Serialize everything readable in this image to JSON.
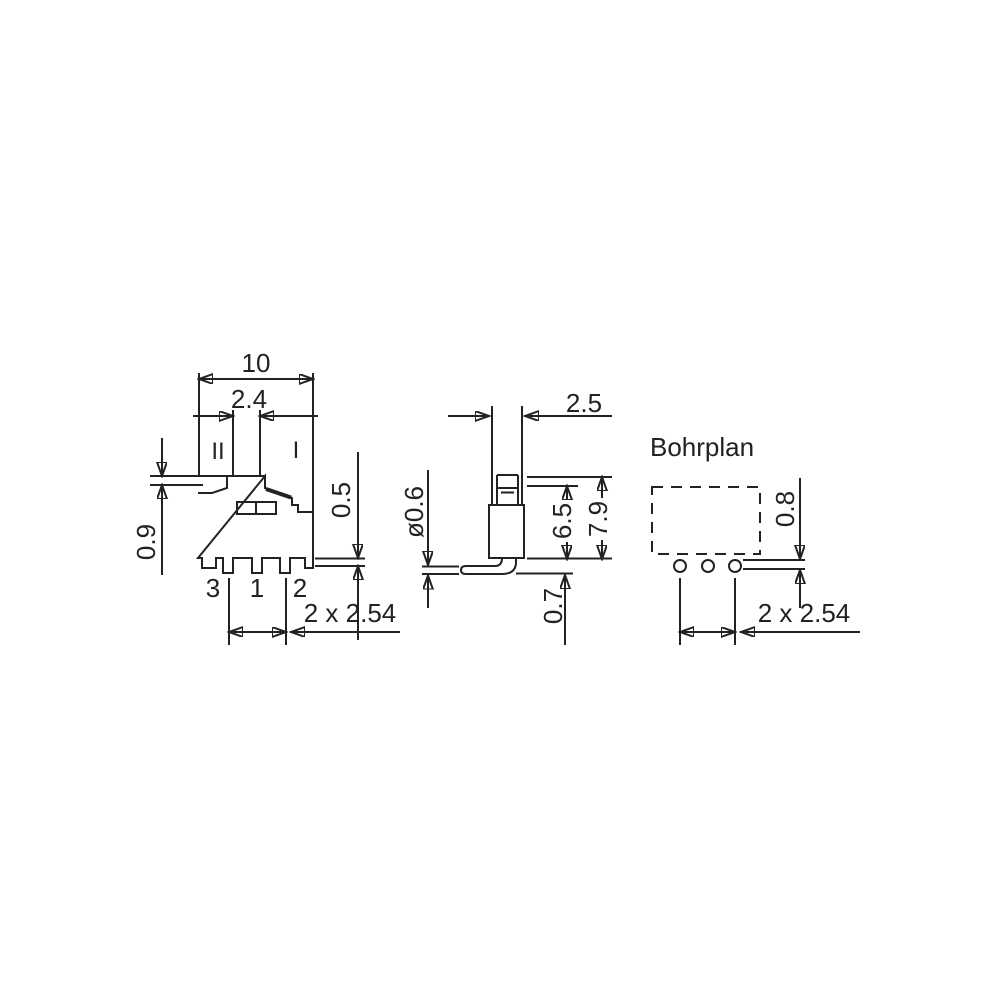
{
  "drawing_labels": {
    "front": {
      "overall_width": "10",
      "knob_width": "2.4",
      "knob_height": "0.9",
      "standoff": "0.5",
      "pos_left": "II",
      "pos_right": "I",
      "pin3": "3",
      "pin1": "1",
      "pin2": "2",
      "pitch": "2 x 2.54"
    },
    "side": {
      "depth": "2.5",
      "pin_dia": "ø0.6",
      "body_height": "6.5",
      "total_height": "7.9",
      "pin_projection": "0.7"
    },
    "drill": {
      "title": "Bohrplan",
      "edge_offset": "0.8",
      "pitch": "2 x 2.54"
    }
  },
  "colors": {
    "line": "#222222",
    "background": "#ffffff"
  }
}
